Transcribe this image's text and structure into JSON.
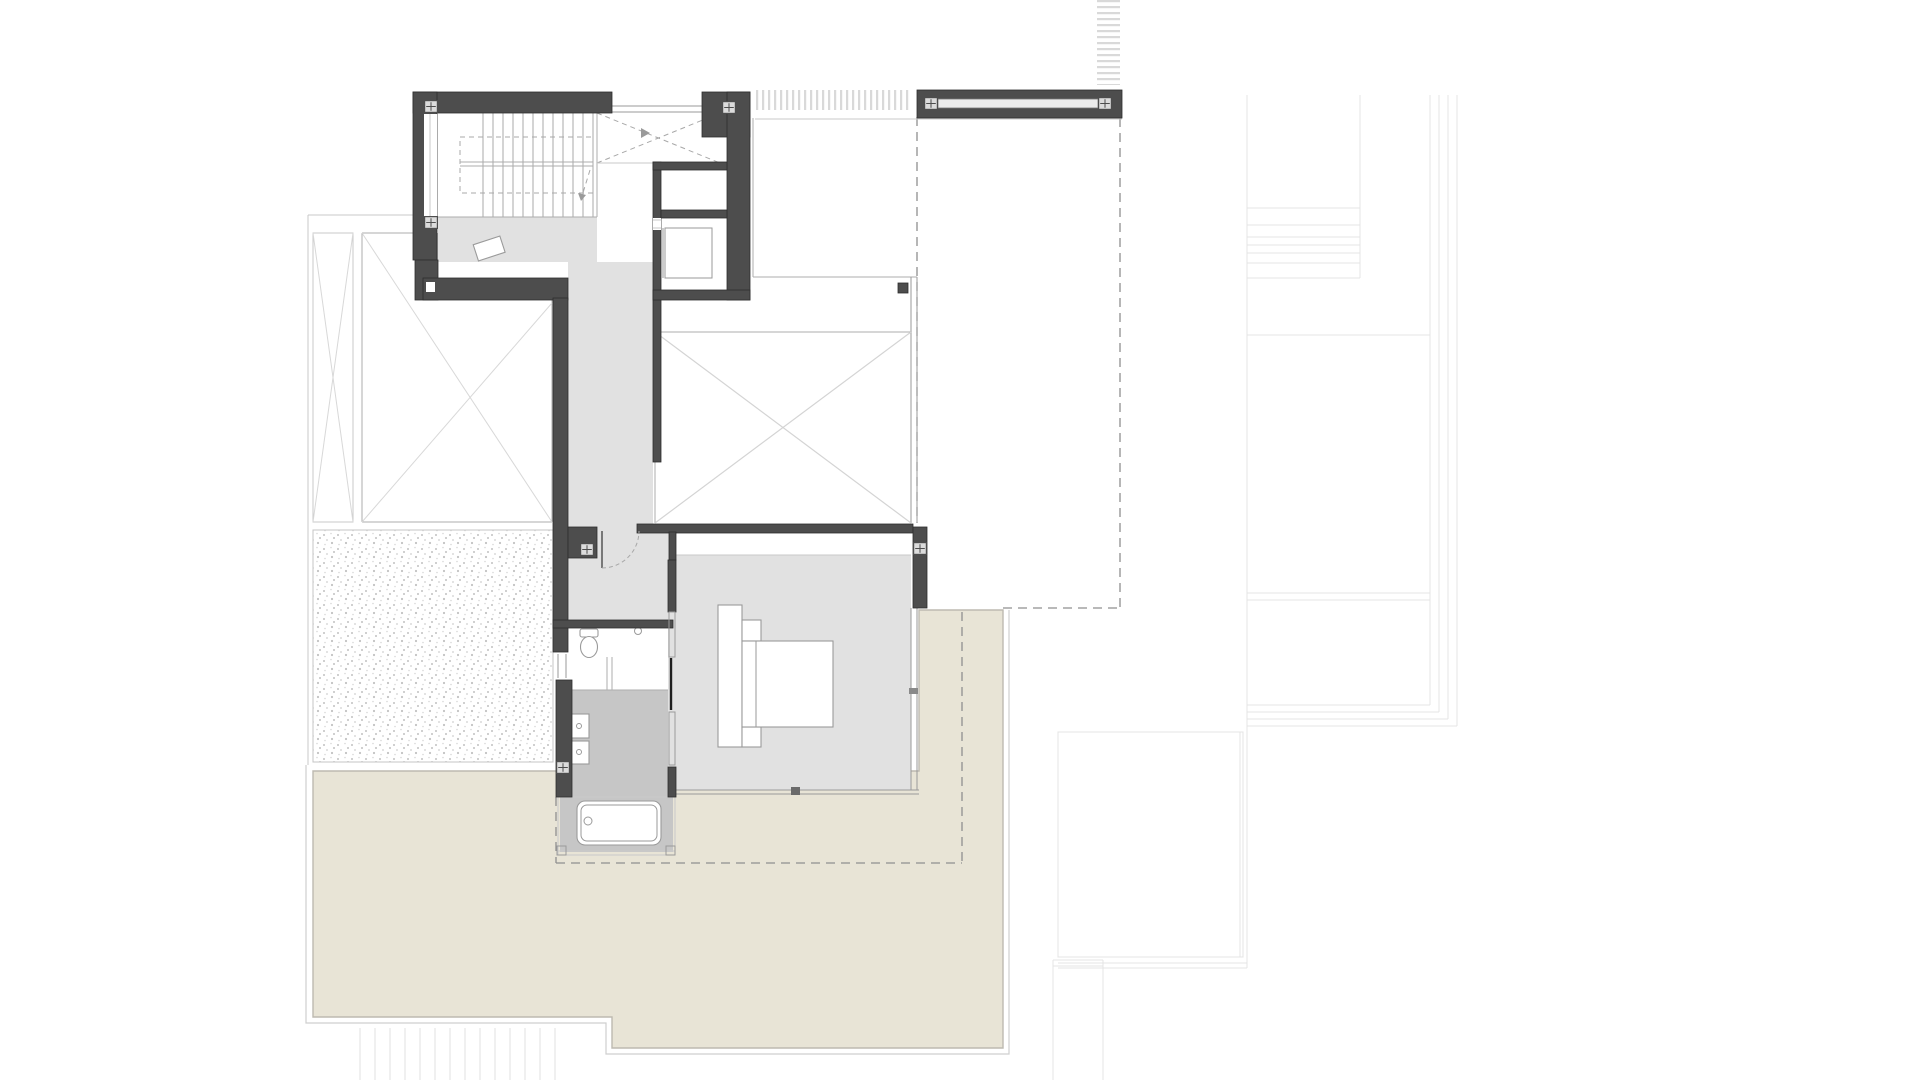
{
  "meta": {
    "kind": "architectural-floor-plan",
    "visible_text": "",
    "floor_shown": "upper-level plan with lower-floor footprint dashed"
  },
  "palette": {
    "background": "#ffffff",
    "wall": "#4d4d4d",
    "wall_stroke": "#2e2e2e",
    "floor": "#e1e1e1",
    "wet_floor": "#c6c6c6",
    "terrace": "#e8e4d6",
    "terrace_stroke": "#bdbab0",
    "terrace_band": "#cfcfcf",
    "line": "#adadad",
    "thin_line": "#c9c9c9",
    "faint_line": "#e4e4e4",
    "dash_line": "#8f8f8f",
    "fixture_stroke": "#9a9a9a",
    "marker_fill": "#dcdcdc",
    "door_dark": "#1f1f1f",
    "stipple_dot": "#c2c2c2",
    "hatch_line": "#d9d9d9"
  },
  "inventory": {
    "rooms": [
      "stairwell",
      "void-over-stairs",
      "elevator-shaft",
      "storage",
      "hallway",
      "central-void",
      "bedroom",
      "bathroom",
      "bath-alcove",
      "left-void-rooms",
      "gravel-courtyard",
      "terrace"
    ],
    "fixtures": [
      "bed",
      "headboard",
      "nightstands",
      "toilet",
      "double-basin",
      "shower",
      "bathtub",
      "floor-mat"
    ],
    "structure": [
      "roof-beam",
      "pergola-louvers",
      "trellis-strip",
      "column-markers",
      "dashed-lower-floor-outline",
      "exterior-steps",
      "site-terracing",
      "neighbor-pool"
    ],
    "counts": {
      "stair_treads": 12,
      "column_markers": 8,
      "exterior_step_lines": 14,
      "terrace_step_lines": 7
    }
  }
}
